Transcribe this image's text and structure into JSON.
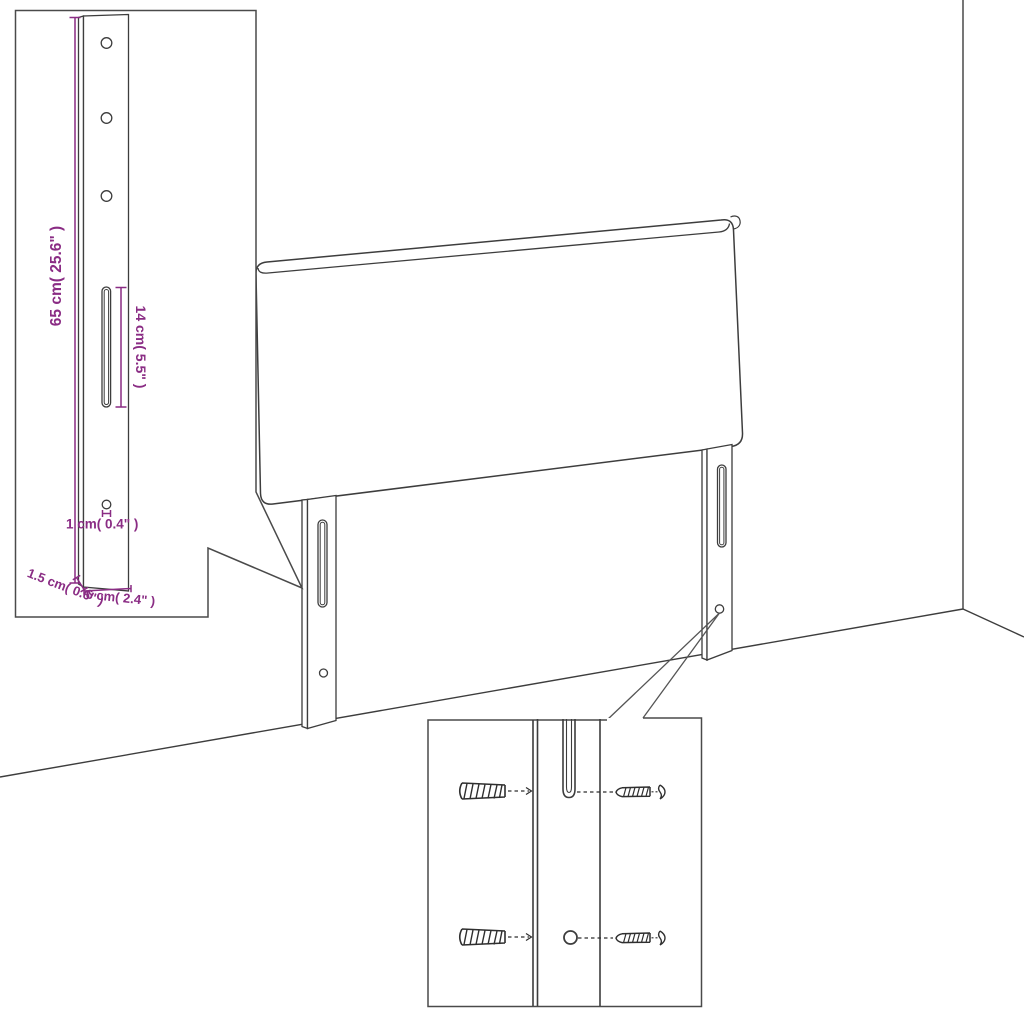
{
  "diagram": {
    "subject": "headboard-with-mounting-legs",
    "style": "line-art-technical-drawing"
  },
  "colors": {
    "background": "#ffffff",
    "line": "#3d3d3d",
    "inset_border": "#4a4a4a",
    "accent": "#8A2C84"
  },
  "dimensions": {
    "leg_height": "65 cm( 25.6\" )",
    "slot_length": "14 cm( 5.5\" )",
    "hole_diameter": "1 cm( 0.4\" )",
    "side_thickness": "1.5 cm( 0.6\" )",
    "leg_width": "6 cm( 2.4\" )"
  },
  "leg_detail_inset": {
    "position": "top-left",
    "part": "mounting-leg-strip",
    "hole_count": 3,
    "has_slot": true,
    "points_to": "left-leg"
  },
  "main_view": {
    "parts": [
      "headboard-panel",
      "left-leg",
      "right-leg"
    ],
    "room": [
      "wall-corner",
      "floor-line"
    ]
  },
  "hardware_detail_inset": {
    "position": "bottom-center",
    "part": "wall-mounting-hardware",
    "items": [
      "wall-plug",
      "screw",
      "wall-plug",
      "screw"
    ],
    "points_to": "right-leg-hole"
  }
}
